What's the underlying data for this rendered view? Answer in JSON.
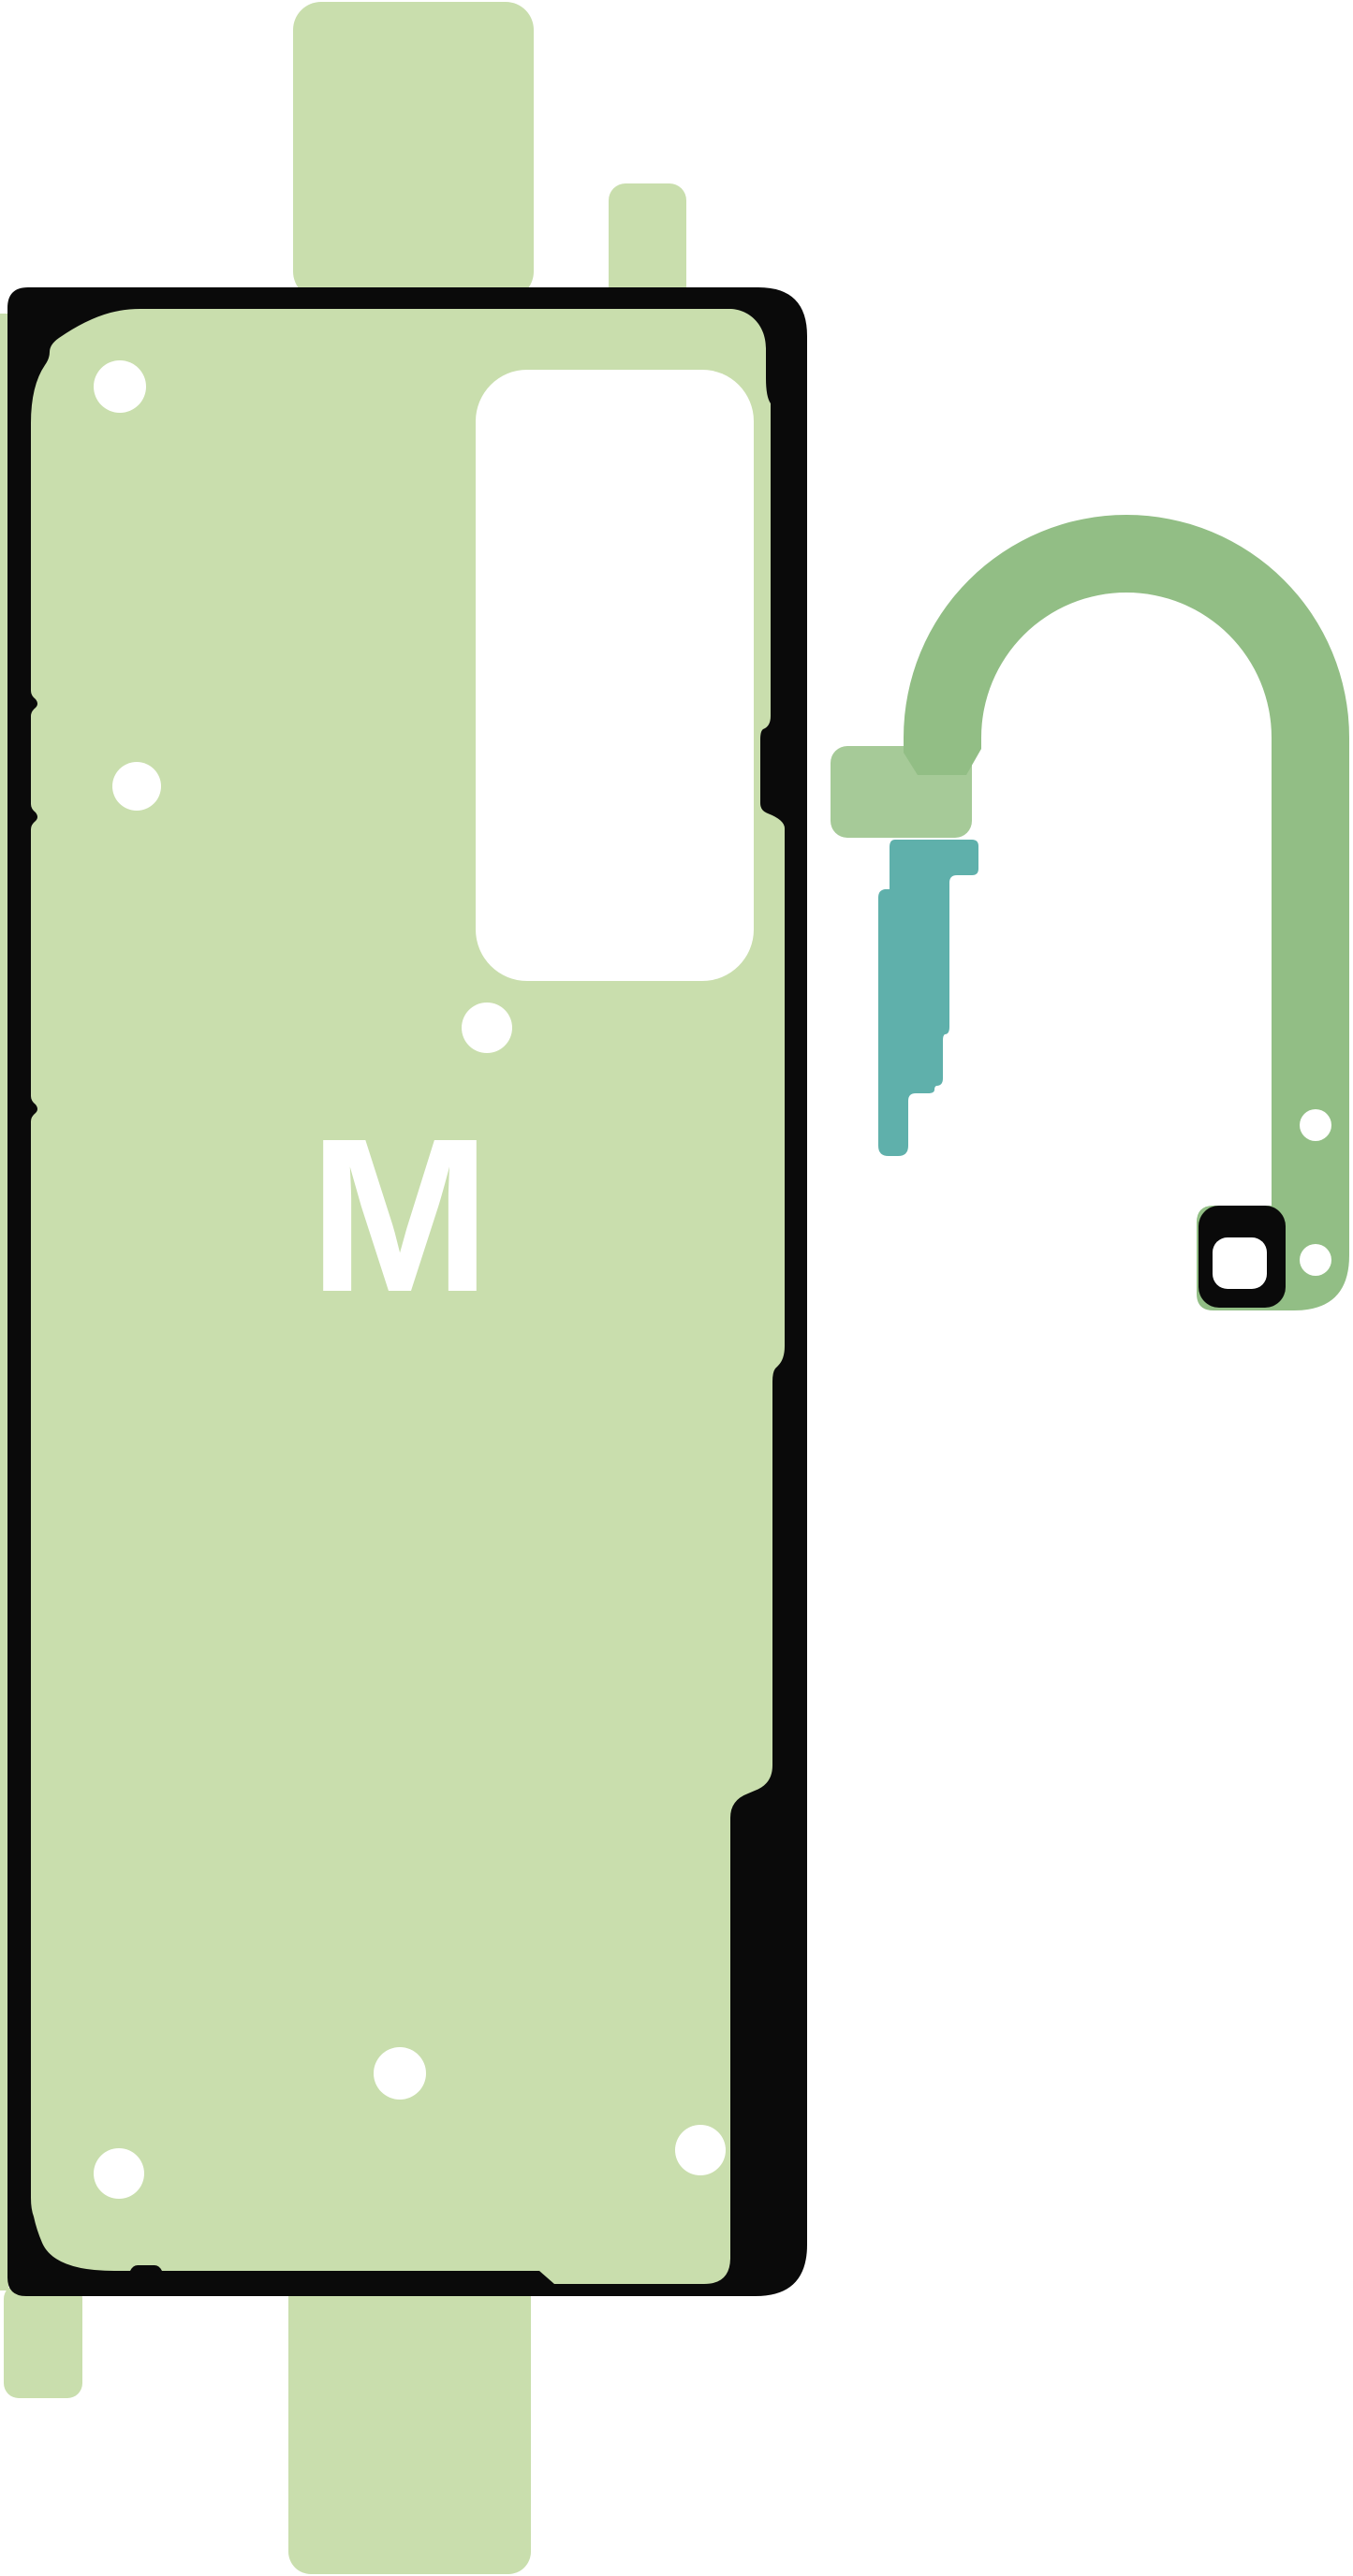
{
  "product_image": {
    "sheet_marking": "M"
  },
  "colors": {
    "background": "#ffffff",
    "sheet_green": "#c9dead",
    "outline_black": "#0a0a0a",
    "hook_green": "#92be85",
    "hook_arm_green": "#a6ca98",
    "teal": "#5fb0ab",
    "white": "#ffffff"
  }
}
